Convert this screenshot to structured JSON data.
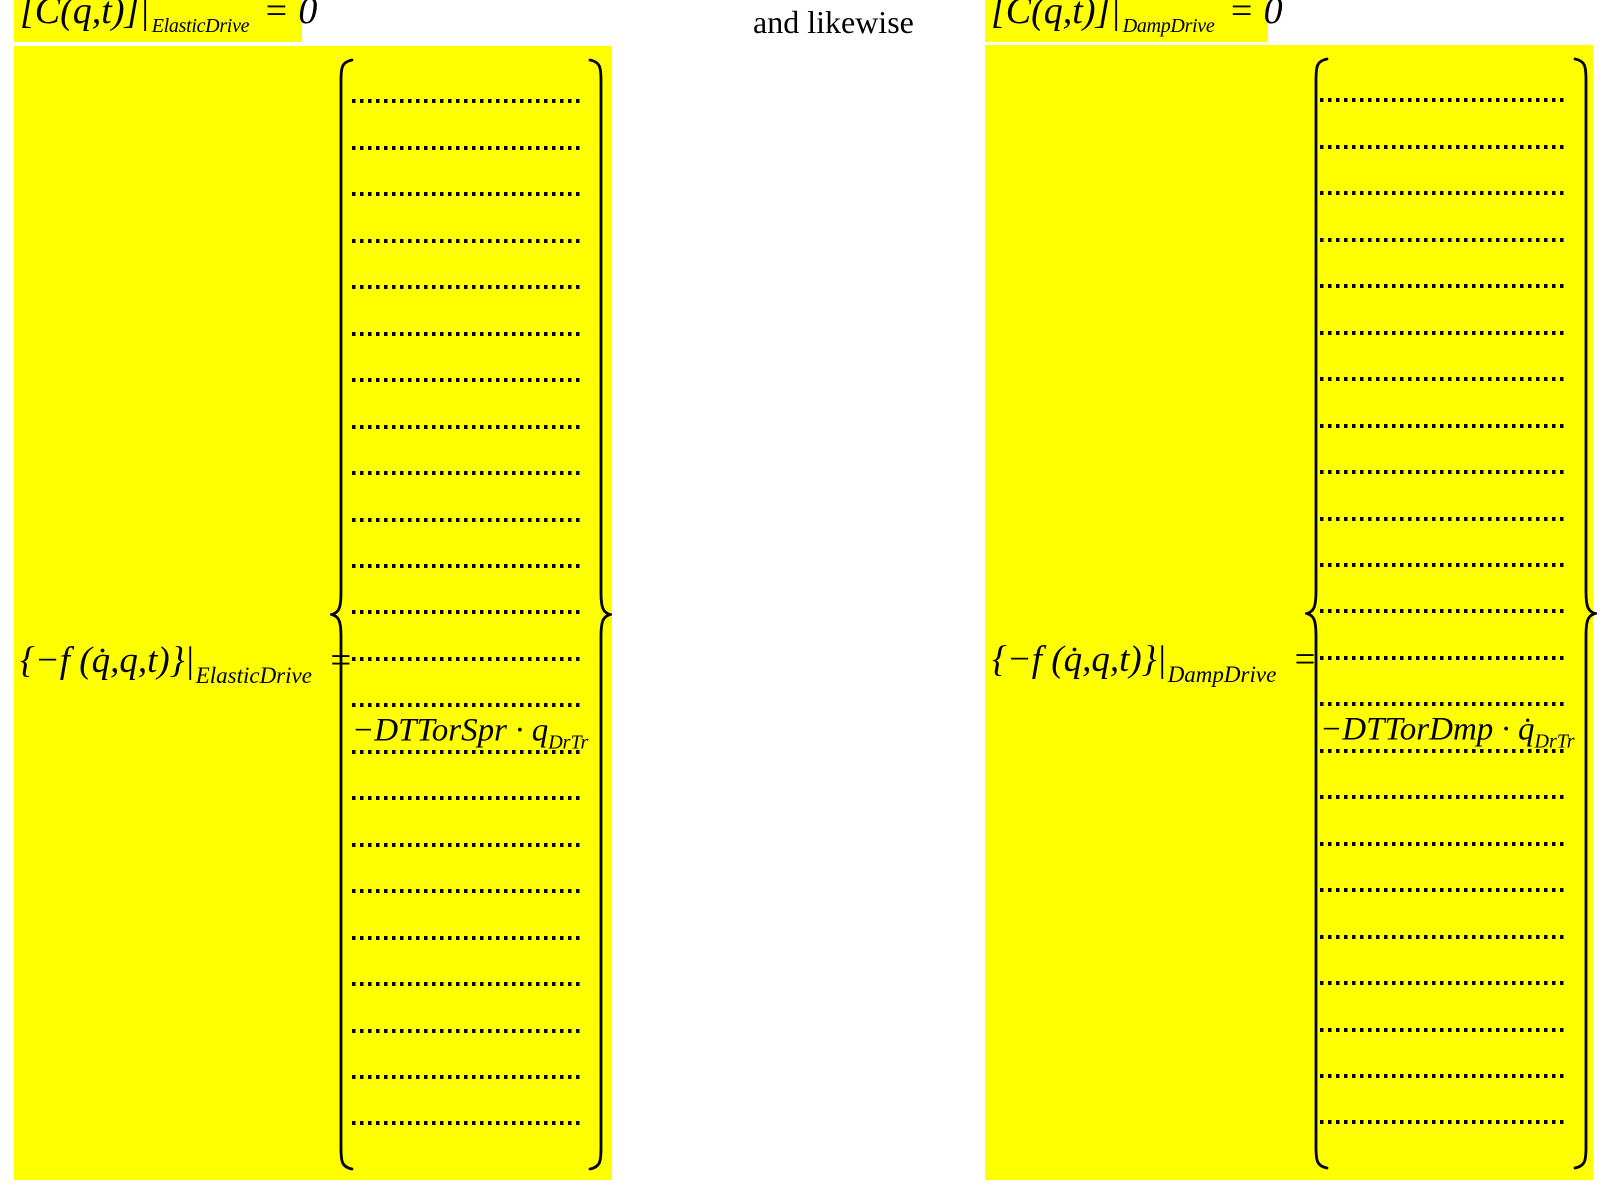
{
  "colors": {
    "highlight": "#ffff00",
    "text": "#000000",
    "page_bg": "#ffffff"
  },
  "top_row": {
    "left_equation": {
      "lhs": "[C(q,t)]|",
      "subscript": "ElasticDrive",
      "rhs": "= 0"
    },
    "connector_text": "and likewise",
    "right_equation": {
      "lhs": "[C(q,t)]|",
      "subscript": "DampDrive",
      "rhs": "= 0"
    }
  },
  "left_block": {
    "label": {
      "lhs": "{−f (q̇,q,t)}|",
      "subscript": "ElasticDrive",
      "equals_sign": "="
    },
    "vector": {
      "row_count": 24,
      "entry_slot": 15,
      "entry_text": "−DTTorSpr · q",
      "entry_subscript": "DrTr"
    }
  },
  "right_block": {
    "label": {
      "lhs": "{−f (q̇,q,t)}|",
      "subscript": "DampDrive",
      "equals_sign": "="
    },
    "vector": {
      "row_count": 24,
      "entry_slot": 15,
      "entry_text": "−DTTorDmp · q̇",
      "entry_subscript": "DrTr"
    }
  }
}
